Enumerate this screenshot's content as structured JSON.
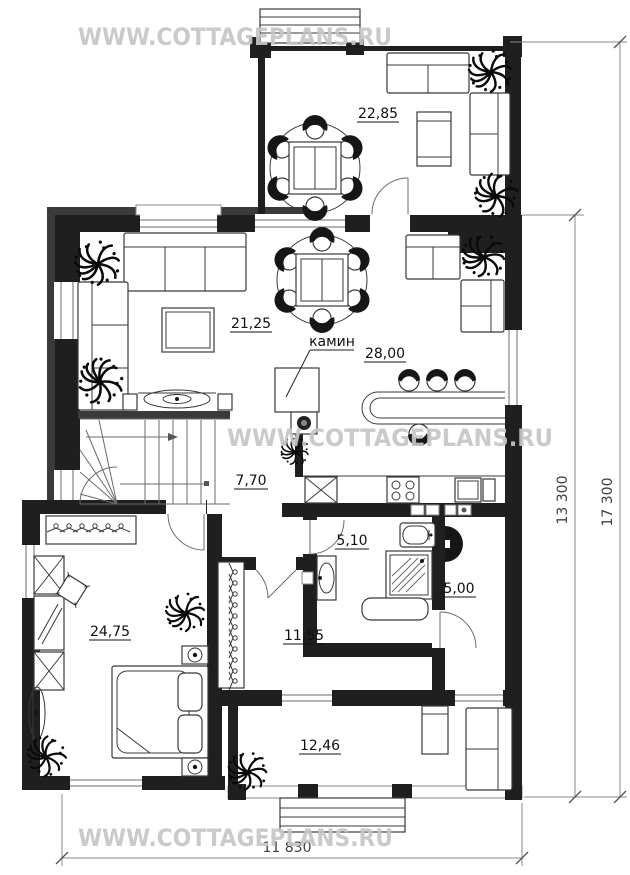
{
  "watermark": {
    "text": "WWW.COTTAGEPLANS.RU"
  },
  "rooms": {
    "veranda": {
      "area": "22,85"
    },
    "living": {
      "area": "21,25"
    },
    "kitchen": {
      "area": "28,00"
    },
    "hall": {
      "area": "7,70"
    },
    "bathroom": {
      "area": "5,10"
    },
    "utility": {
      "area": "5,00"
    },
    "dressing": {
      "area": "11,55"
    },
    "bedroom": {
      "area": "24,75"
    },
    "terrace": {
      "area": "12,46"
    }
  },
  "annotations": {
    "fireplace": "камин"
  },
  "dimensions": {
    "right_inner": "13 300",
    "right_outer": "17 300",
    "bottom": "11 830"
  },
  "colors": {
    "wall": "#1f1f1f",
    "watermark": "#c6c6c6",
    "dimension": "#8a8a8a",
    "line": "#3a3a3a"
  }
}
